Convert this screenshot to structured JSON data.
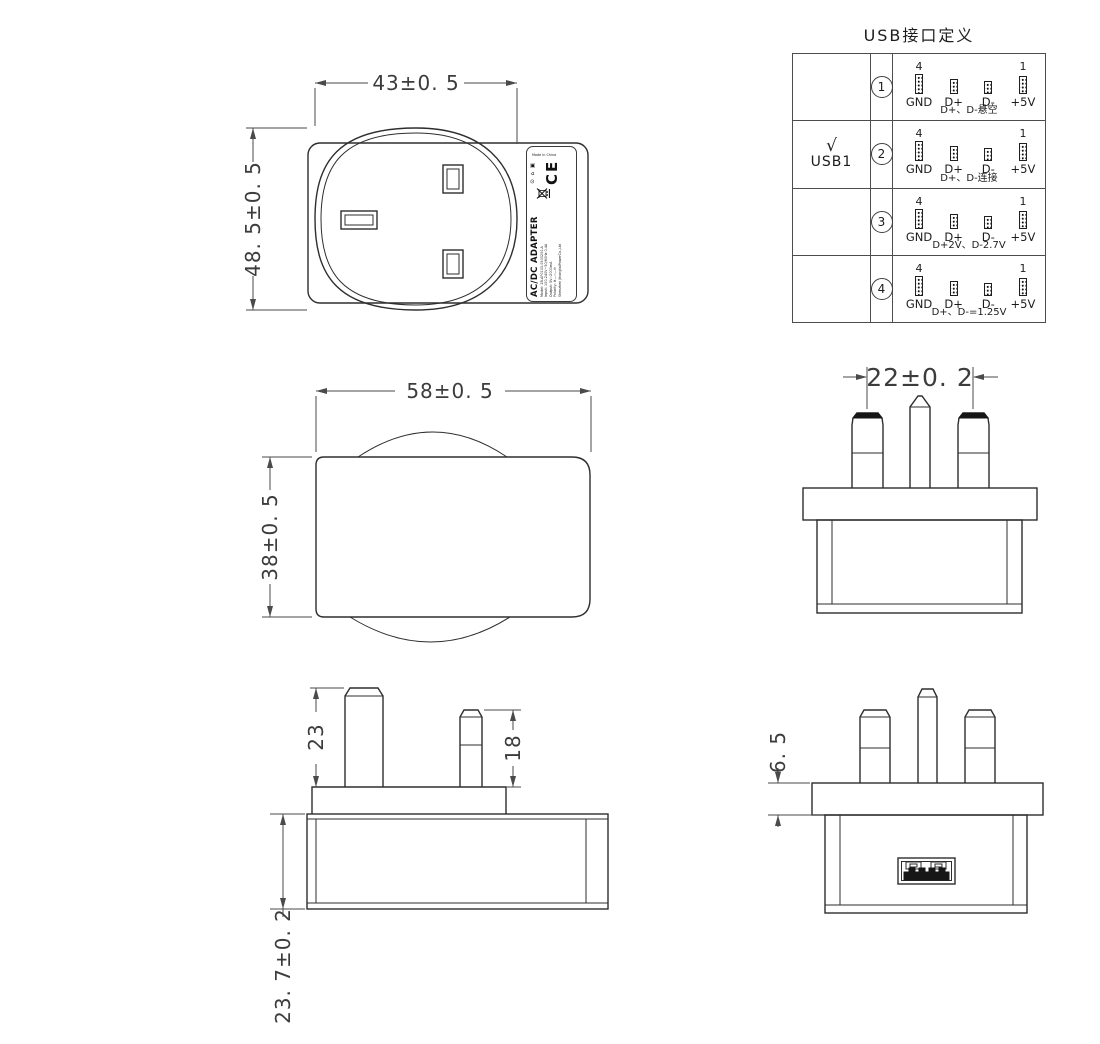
{
  "usb_table": {
    "title": "USB接口定义",
    "pin4_label": "4",
    "pin1_label": "1",
    "pin_labels": [
      "GND",
      "D+",
      "D-",
      "+5V"
    ],
    "rows": [
      {
        "index": "1",
        "note": "D+、D-悬空"
      },
      {
        "index": "2",
        "check": "√",
        "port": "USB1",
        "note": "D+、D-连接"
      },
      {
        "index": "3",
        "note": "D+2V、D-2.7V"
      },
      {
        "index": "4",
        "note": "D+、D-=1.25V"
      }
    ]
  },
  "dimensions": {
    "rear_width": "43±0. 5",
    "rear_height": "48. 5±0. 5",
    "side_width": "58±0. 5",
    "side_height": "38±0. 5",
    "pin_spacing": "22±0. 2",
    "earth_pin_length": "23",
    "power_pin_length": "18",
    "body_height": "23. 7±0. 2",
    "flange_thickness": "6. 5"
  },
  "label": {
    "title": "AC/DC ADAPTER",
    "lines": [
      "Model: 2B-AP0100-0500200-A",
      "Input: 100-240V~50/60Hz 0.4A",
      "Output: 5V⎓2000mA",
      "Polarity: ⊕—⎓—⊖"
    ],
    "company": "Shenzhen JihongtaiPowerCo.,Ltd",
    "made_in": "Made in China",
    "ce": "CE",
    "icons": "⊙ ⌂ ▣"
  }
}
